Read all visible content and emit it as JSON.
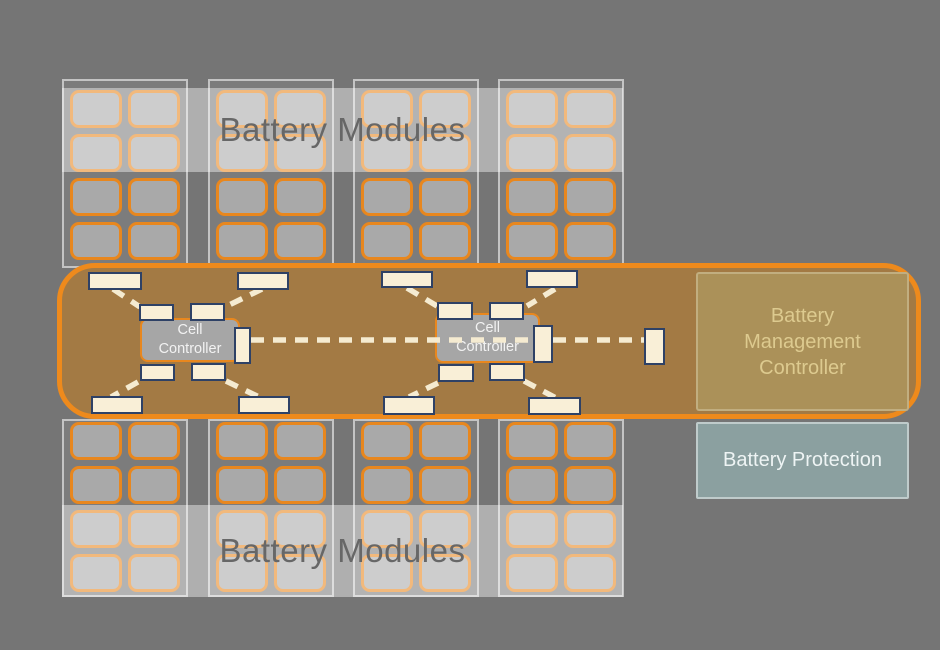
{
  "labels": {
    "modules_top": "Battery Modules",
    "modules_bottom": "Battery Modules"
  },
  "cell_controllers": [
    {
      "line1": "Cell",
      "line2": "Controller"
    },
    {
      "line1": "Cell",
      "line2": "Controller"
    }
  ],
  "bmc": {
    "line1": "Battery",
    "line2": "Management",
    "line3": "Controller"
  },
  "battery_protection": {
    "label": "Battery Protection"
  },
  "modules": {
    "count": 8,
    "cells_per_module": 8,
    "grid": "2x4"
  },
  "colors": {
    "background": "#757575",
    "bus_border": "#ee8a1c",
    "bus_fill": "#a37b46",
    "cell_fill": "#a9a9a9",
    "cell_border": "#e8871e",
    "tap_fill": "#f9efd7",
    "tap_border": "#2e4166",
    "dash_line": "#f5ebd1",
    "controller_fill": "#a6a6a6",
    "bmc_fill": "#ab9159",
    "bmc_text": "#ddca8f",
    "protection_fill": "#8ba0a0",
    "band_overlay": "rgba(255,255,255,0.42)",
    "band_text": "#676767"
  }
}
